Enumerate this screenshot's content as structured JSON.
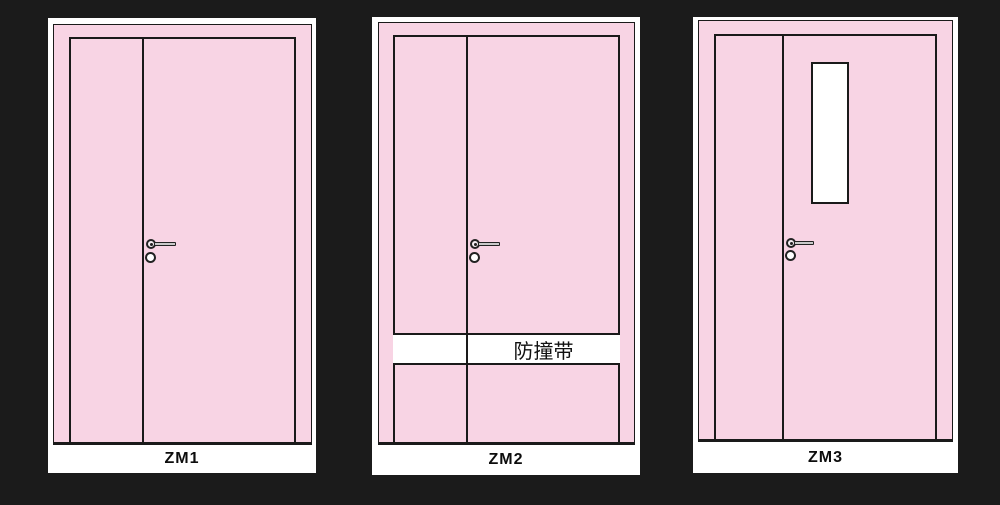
{
  "colors": {
    "bg": "#1b1b1b",
    "panel": "#ffffff",
    "pink": "#f8d4e4",
    "line": "#1a1a1a",
    "metal": "#c9c9c9"
  },
  "panels": [
    {
      "label": "ZM1",
      "type": "unequal double-leaf door"
    },
    {
      "label": "ZM2",
      "type": "unequal double-leaf door with bumper strip",
      "band_label": "防撞带"
    },
    {
      "label": "ZM3",
      "type": "unequal double-leaf door with vision panel"
    }
  ]
}
